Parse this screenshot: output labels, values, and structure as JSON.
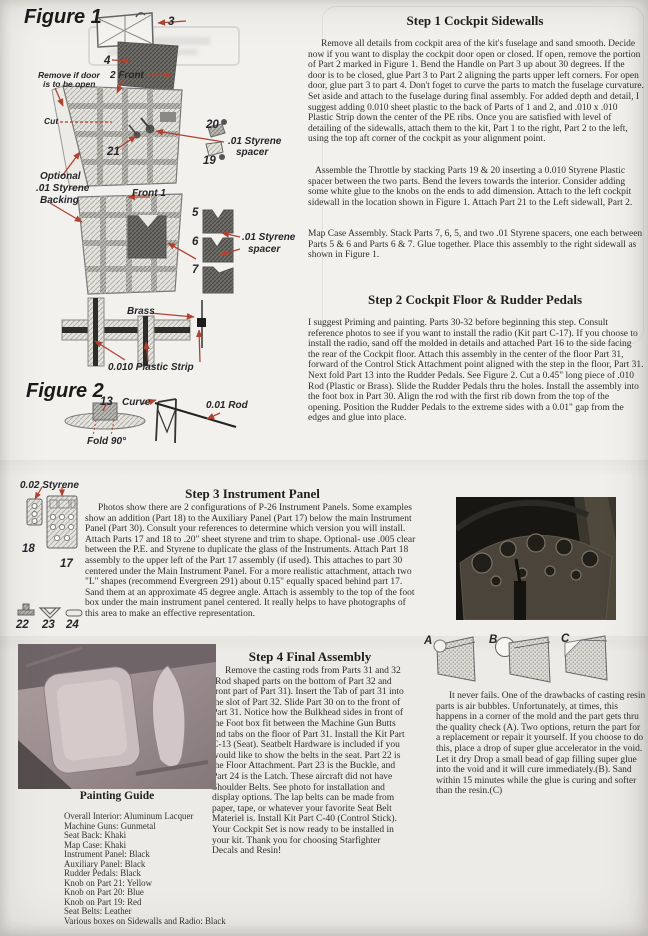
{
  "figure1": {
    "title": "Figure 1",
    "labels": {
      "part3": "3",
      "part4": "4",
      "front2": "2  Front",
      "remove1": "Remove if door",
      "remove2": "is to be open",
      "cut": "Cut",
      "part20": "20",
      "part19": "19",
      "part21": "21",
      "spacer_a1": ".01 Styrene",
      "spacer_a2": "spacer",
      "optional1": "Optional",
      "optional2": ".01 Styrene",
      "optional3": "Backing",
      "front1": "Front  1",
      "part5": "5",
      "part6": "6",
      "part7": "7",
      "spacer_b1": ".01 Styrene",
      "spacer_b2": "spacer",
      "brass": "Brass",
      "strip": "0.010 Plastic Strip"
    }
  },
  "figure2": {
    "title": "Figure 2",
    "labels": {
      "part13": "13",
      "curve": "Curve",
      "rod": "0.01 Rod",
      "fold": "Fold 90°"
    }
  },
  "step1": {
    "title": "Step 1 Cockpit Sidewalls",
    "p1": "Remove all details from cockpit area of the kit's fuselage and sand smooth. Decide now if you want to display the cockpit door open or closed. If open, remove the portion of Part 2  marked in Figure 1.  Bend the Handle on Part 3 up about 30 degrees. If the door is to be closed, glue Part 3 to Part 2 aligning the parts upper left corners. For open door, glue part 3 to part 4. Don't foget to curve the parts to match the fuselage curvature. Set aside and attach to the fuselage during final assembly. For added depth and detail, I suggest adding 0.010 sheet plastic to the back of Parts of 1 and 2, and .010 x .010  Plastic Strip down the center of the PE ribs. Once you are satisfied with level of detailing of the sidewalls, attach them to the kit, Part 1 to the right, Part 2 to the left, using the top aft corner of the cockpit as your alignment point.",
    "p2": "Assemble the Throttle by stacking Parts 19 & 20 inserting a 0.010 Styrene Plastic spacer between the two parts. Bend the levers  towards the interior. Consider adding some white glue to the knobs on the ends to add dimension. Attach to the left cockpit sidewall in the location shown in Figure 1. Attach Part 21 to the Left sidewall, Part 2.",
    "p3": "Map Case Assembly. Stack Parts 7, 6, 5, and two .01 Styrene spacers, one each between Parts 5 & 6 and Parts 6 & 7. Glue together. Place this assembly to the right sidewall as shown in Figure 1."
  },
  "step2": {
    "title": "Step 2 Cockpit Floor & Rudder Pedals",
    "p1": "I suggest Priming and painting. Parts 30-32 before beginning this step. Consult reference photos to see if you want to install the radio (Kit part C-17). If you choose to install the radio, sand off the molded in details and attached Part 16 to the side facing the rear of the Cockpit floor. Attach this assembly in the center of the floor Part 31, forward  of the Control Stick Attachment point aligned with the step in the floor, Part 31. Next fold Part 13 into the Rudder Pedals. See Figure 2. Cut a 0.45\" long piece of .010 Rod (Plastic or Brass). Slide the Rudder Pedals thru the holes. Install the assembly into the foot box in Part 30. Align the rod with the first rib down from the top of the opening. Position the Rudder Pedals to the extreme sides with a 0.01\" gap from the edges and glue into place."
  },
  "step3": {
    "title": "Step 3 Instrument Panel",
    "p1": "Photos show there are 2 configurations of P-26 Instrument Panels. Some examples show an addition (Part 18) to the Auxiliary Panel (Part 17)  below the main Instrument Panel (Part 30). Consult your references to determine which version you will install. Attach Parts 17 and 18 to .20\" sheet styrene and trim to shape. Optional- use .005 clear between the P.E.  and Styrene to duplicate the glass of the Instruments. Attach Part 18 assembly to the upper left of the Part 17 assembly (if used). This attaches to part 30 centered under the Main Instrument Panel. For a more realistic attachment, attach two \"L\" shapes (recommend Evergreen 291) about 0.15\" equally spaced behind part 17. Sand them at an approximate 45 degree angle. Attach is assembly to the top of the foot box under the main instrument panel centered. It really helps to have photographs of this area to make an effective representation.",
    "labels": {
      "styrene": "0.02 Styrene",
      "part18": "18",
      "part17": "17",
      "part22": "22",
      "part23": "23",
      "part24": "24"
    }
  },
  "step4": {
    "title": "Step 4 Final Assembly",
    "p1": "Remove the casting rods from Parts 31 and 32 (Rod shaped parts on the bottom of Part 32 and front part of Part 31). Insert the Tab of part 31 into the slot of Part 32. Slide Part 30 on to the front of Part 31. Notice how the Bulkhead sides in front of the Foot box  fit between the Machine Gun Butts and tabs on the floor of Part 31. Install the Kit Part C-13 (Seat). Seatbelt Hardware is included if you would like to show the belts in the seat. Part 22 is the Floor Attachment. Part 23 is the Buckle, and Part 24 is the Latch. These aircraft did not have Shoulder Belts. See photo for installation and display options. The lap belts can be made from paper, tape, or whatever your favorite Seat Belt Materiel is. Install Kit Part C-40 (Control Stick). Your Cockpit Set is now ready to be installed in your kit. Thank you for choosing Starfighter Decals and Resin!"
  },
  "resin_note": {
    "p1": "It never fails. One of the drawbacks of casting resin parts is air bubbles. Unfortunately, at times, this happens in a corner of the mold and the part gets thru the quality check (A). Two options, return the part for a replacement or repair it yourself. If you choose to do this, place a drop of super glue accelerator in the void. Let it dry Drop a small bead of gap filling super glue into the void and it will cure immediately.(B). Sand within 15 minutes while the glue is curing and softer than the resin.(C)",
    "labels": {
      "a": "A",
      "b": "B",
      "c": "C"
    }
  },
  "painting_guide": {
    "title": "Painting Guide",
    "items": [
      "Overall Interior: Aluminum Lacquer",
      "Machine Guns: Gunmetal",
      "Seat Back: Khaki",
      "Map Case: Khaki",
      "Instrument Panel: Black",
      "Auxiliary Panel: Black",
      "Rudder Pedals: Black",
      "Knob on Part 21: Yellow",
      "Knob on Part 20: Blue",
      "Knob on Part 19: Red",
      "Seat Belts: Leather",
      "Various boxes on Sidewalls and Radio: Black"
    ]
  },
  "colors": {
    "arrow_red": "#b04232",
    "paper": "#f0efeb"
  }
}
